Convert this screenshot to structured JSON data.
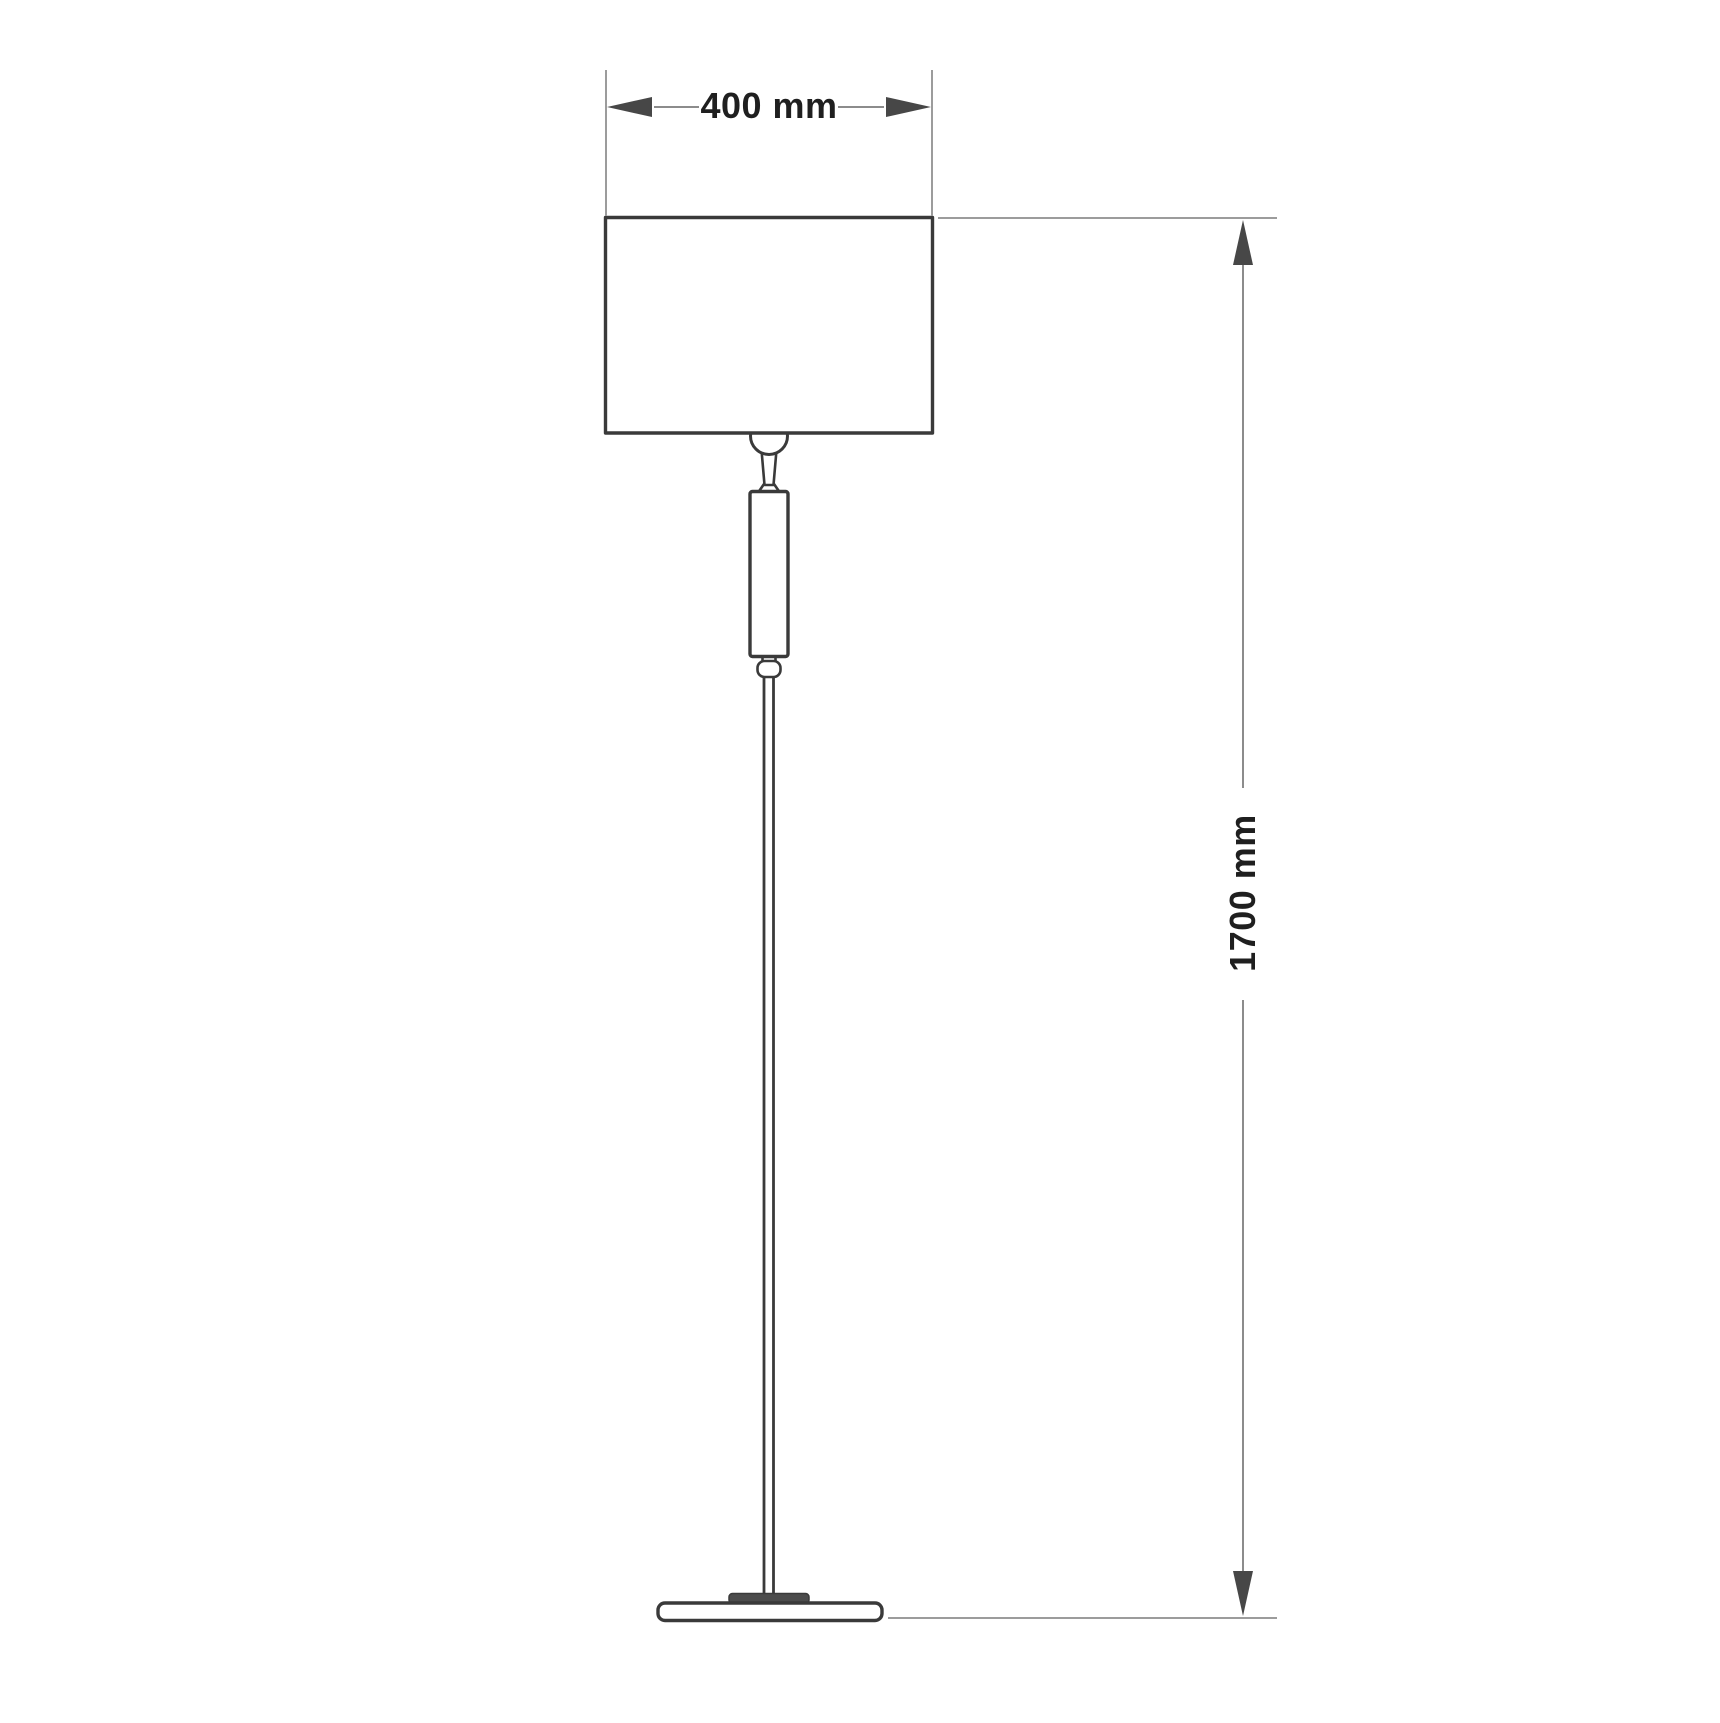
{
  "figure": {
    "kind": "technical-dimension-diagram",
    "subject": "floor lamp side elevation outline",
    "background": "#ffffff",
    "colors": {
      "lamp_outline": "#3a3a3a",
      "extension_line": "#9c9c9c",
      "dimension_line": "#8c8c8c",
      "arrowhead": "#474747",
      "label_text": "#1f1f1f"
    }
  },
  "dimensions": {
    "shade_width": {
      "label": "400 mm",
      "value": 400,
      "unit": "mm",
      "orientation": "horizontal"
    },
    "overall_height": {
      "label": "1700 mm",
      "value": 1700,
      "unit": "mm",
      "orientation": "vertical"
    }
  }
}
